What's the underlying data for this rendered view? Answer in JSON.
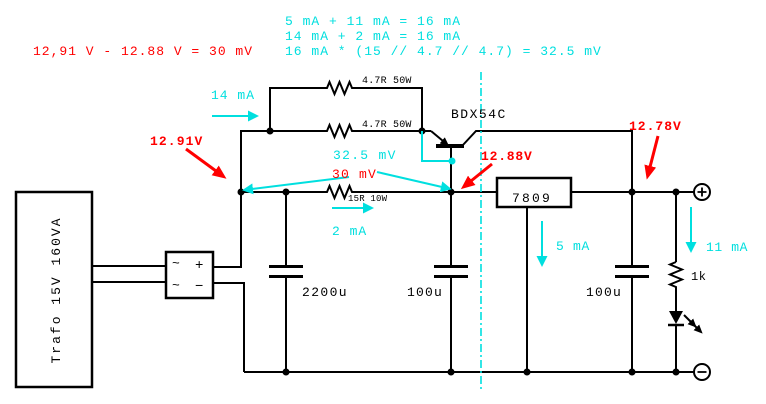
{
  "title": "power-supply-current-boost-schematic",
  "colors": {
    "wire": "#000000",
    "annotation_red": "#ff0000",
    "annotation_cyan": "#00dfdf",
    "background": "#ffffff"
  },
  "formulas": {
    "red_voltage_drop": "12,91 V - 12.88 V = 30 mV",
    "cyan_sum_out": "5 mA + 11 mA = 16 mA",
    "cyan_sum_in": "14 mA + 2 mA = 16 mA",
    "cyan_product": "16 mA * (15 // 4.7 // 4.7) = 32.5 mV"
  },
  "components": {
    "transformer": "Trafo 15V 160VA",
    "bridge": {
      "ac_top": "~",
      "plus": "+",
      "ac_bottom": "~",
      "minus": "−"
    },
    "resistor_bypass_top": "4.7R  50W",
    "resistor_bypass_bottom": "4.7R  50W",
    "resistor_sense": "15R 10W",
    "transistor": "BDX54C",
    "regulator": "7809",
    "cap_reservoir": "2200u",
    "cap_input": "100u",
    "cap_output": "100u",
    "resistor_led": "1k"
  },
  "measurements": {
    "v_input": "12.91V",
    "v_regulator_in": "12.88V",
    "v_output": "12.78V",
    "mv_calculated": "32.5 mV",
    "mv_measured": "30 mV",
    "i_bypass": "14 mA",
    "i_sense": "2 mA",
    "i_regulator": "5 mA",
    "i_load": "11 mA"
  },
  "terminals": {
    "positive_icon": "plus-circle",
    "negative_icon": "minus-circle"
  }
}
